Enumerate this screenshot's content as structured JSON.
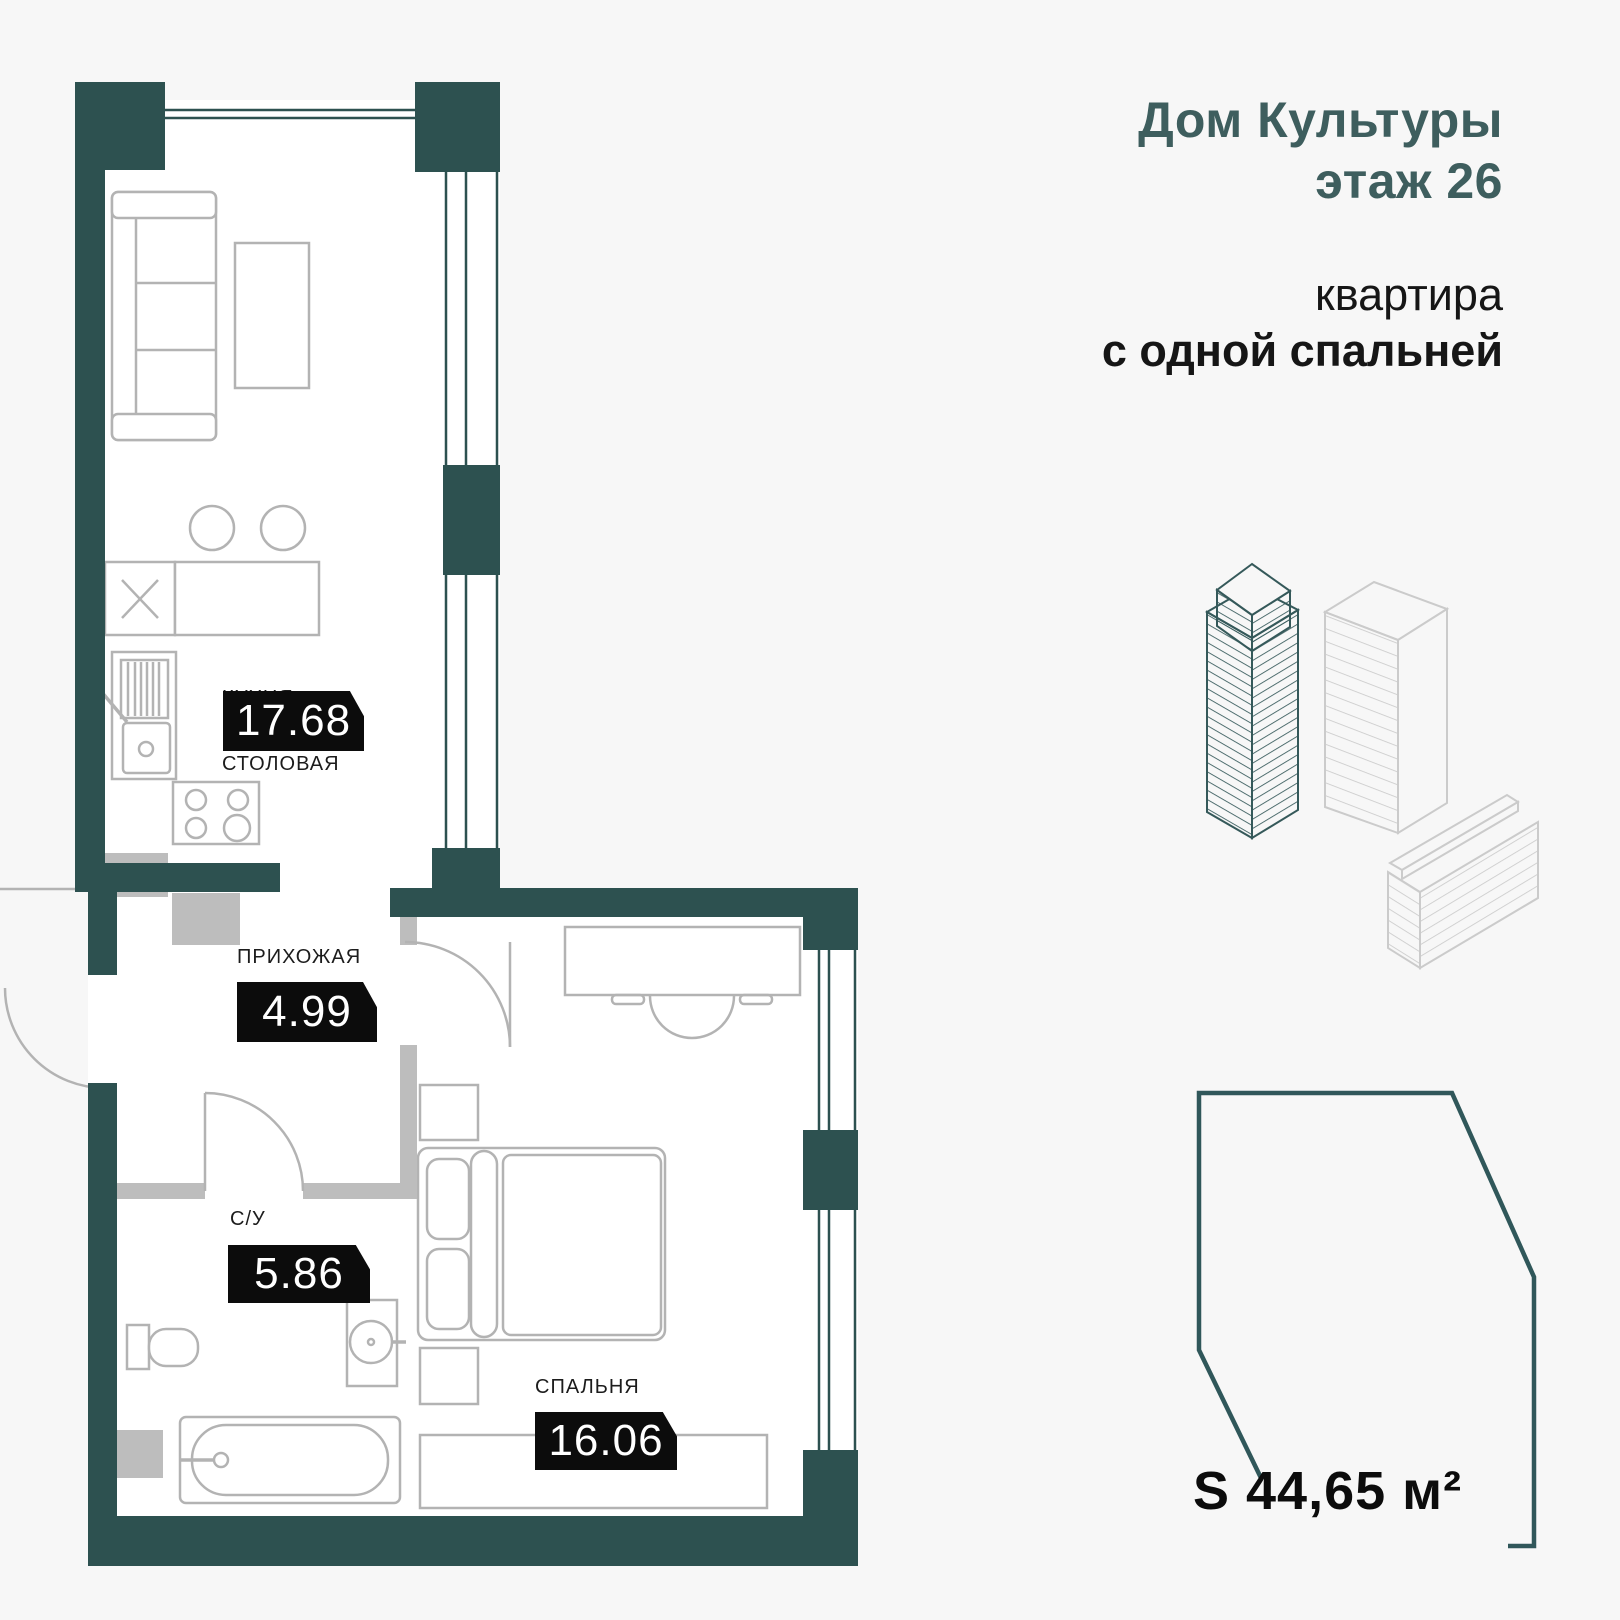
{
  "header": {
    "building": "Дом Культуры",
    "floor": "этаж 26",
    "apt_line1": "квартира",
    "apt_line2": "с одной спальней"
  },
  "rooms": {
    "kitchen": {
      "label_line1": "КУХНЯ-",
      "label_line2": "СТОЛОВАЯ",
      "area": "17.68"
    },
    "hallway": {
      "label": "ПРИХОЖАЯ",
      "area": "4.99"
    },
    "bathroom": {
      "label": "С/У",
      "area": "5.86"
    },
    "bedroom": {
      "label": "СПАЛЬНЯ",
      "area": "16.06"
    }
  },
  "total": {
    "area_label": "S 44,65 м²"
  },
  "colors": {
    "background": "#f7f7f7",
    "wall_teal": "#2d5150",
    "accent_teal": "#3e5e5e",
    "partition_gray": "#bdbdbd",
    "furniture_gray": "#b3b3b3",
    "badge_black": "#0c0c0c",
    "building_outline_teal": "#35595a",
    "building_outline_gray": "#cbcbcb"
  }
}
